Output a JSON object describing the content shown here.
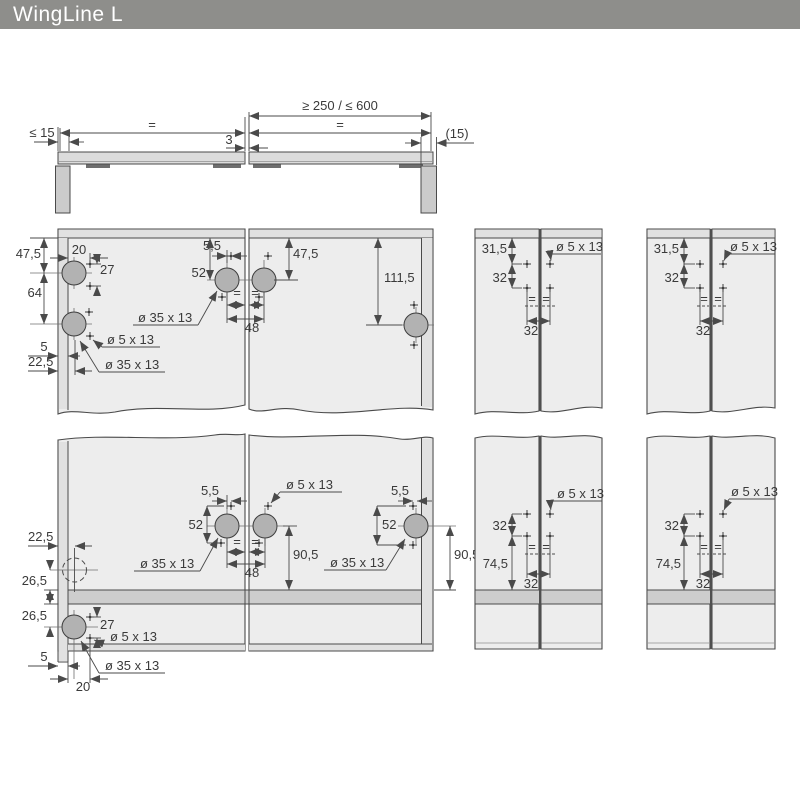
{
  "header": {
    "title": "WingLine L"
  },
  "colors": {
    "header_bg": "#8e8e8b",
    "door_fill": "#ededed",
    "edge_fill": "#e1e1e1",
    "shelf_fill": "#cdcdcd",
    "cup_fill": "#b2b2b2",
    "junction": "#4f4f4f",
    "line": "#4a4a4a",
    "text": "#3a3a3a"
  },
  "plan_view": {
    "width_range": "≥ 250 / ≤ 600",
    "equal_left": "=",
    "equal_right": "=",
    "side_clearance": "≤ 15",
    "door_gap": "3",
    "overlay": "(15)"
  },
  "upper_front": {
    "left_door": {
      "top_offset": "47,5",
      "cup_spacing": "64",
      "hole_inset": "20",
      "hole_spacing": "27",
      "edge_gap": "5",
      "cup_inset": "22,5",
      "small_hole_label": "ø 5 x 13",
      "cup_hole_label": "ø 35 x 13"
    },
    "junction": {
      "hole_offset": "5,5",
      "top_offset": "52",
      "cup_hole_label": "ø 35 x 13",
      "cup_spacing": "48",
      "equal_left": "=",
      "equal_right": "="
    },
    "right_door": {
      "top_offset": "47,5",
      "cup_offset": "111,5"
    }
  },
  "lower_front": {
    "left_door": {
      "cup_inset": "22,5",
      "above_shelf": "26,5",
      "below_shelf": "26,5",
      "hole_spacing": "27",
      "small_hole_label": "ø 5 x 13",
      "cup_hole_label": "ø 35 x 13",
      "edge_gap": "5",
      "hole_inset": "20"
    },
    "junction": {
      "small_hole_label": "ø 5 x 13",
      "hole_offset": "5,5",
      "hole_spacing": "52",
      "cup_hole_label": "ø 35 x 13",
      "cup_spacing": "48",
      "shelf_offset": "90,5",
      "equal_left": "=",
      "equal_right": "="
    },
    "right_door": {
      "hole_offset": "5,5",
      "hole_spacing": "52",
      "cup_hole_label": "ø 35 x 13",
      "shelf_offset": "90,5"
    }
  },
  "narrow_top": [
    {
      "top_offset": "31,5",
      "row_spacing": "32",
      "col_spacing": "32",
      "small_hole_label": "ø 5 x 13",
      "equal_left": "=",
      "equal_right": "="
    },
    {
      "top_offset": "31,5",
      "row_spacing": "32",
      "col_spacing": "32",
      "small_hole_label": "ø 5 x 13",
      "equal_left": "=",
      "equal_right": "="
    }
  ],
  "narrow_bottom": [
    {
      "row_spacing": "32",
      "shelf_offset": "74,5",
      "col_spacing": "32",
      "small_hole_label": "ø 5 x 13",
      "equal_left": "=",
      "equal_right": "="
    },
    {
      "row_spacing": "32",
      "shelf_offset": "74,5",
      "col_spacing": "32",
      "small_hole_label": "ø 5 x 13",
      "equal_left": "=",
      "equal_right": "="
    }
  ]
}
